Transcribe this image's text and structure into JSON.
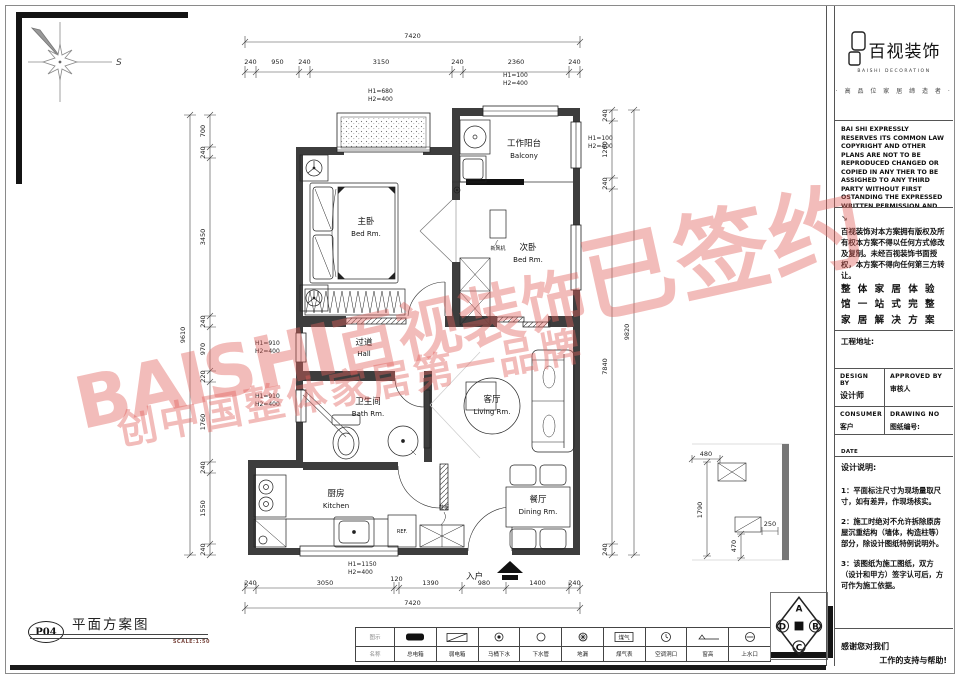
{
  "sheet": {
    "number": "P04",
    "title": "平面方案图",
    "scale": "SCALE:1:50"
  },
  "compass": {
    "south_label": "S"
  },
  "watermark": {
    "line1_latin": "BAISHI",
    "line1_cn": "百视装饰",
    "line1_tail": "已签约",
    "line2": "创中国整体家居第一品牌"
  },
  "plan": {
    "rooms": [
      {
        "cn": "主卧",
        "en": "Bed Rm."
      },
      {
        "cn": "工作阳台",
        "en": "Balcony"
      },
      {
        "cn": "次卧",
        "en": "Bed Rm."
      },
      {
        "cn": "过道",
        "en": "Hall"
      },
      {
        "cn": "卫生间",
        "en": "Bath Rm."
      },
      {
        "cn": "客厅",
        "en": "Living Rm."
      },
      {
        "cn": "厨房",
        "en": "Kitchen"
      },
      {
        "cn": "餐厅",
        "en": "Dining Rm."
      }
    ],
    "labels": {
      "entrance": "入户",
      "fridge": "REF.",
      "shoe_cabinet": "鞋柜",
      "fresh_air": "新风机"
    },
    "window_tags": [
      {
        "h1": "H1=680",
        "h2": "H2=400"
      },
      {
        "h1": "H1=100",
        "h2": "H2=400"
      },
      {
        "h1": "H1=100",
        "h2": "H2=400"
      },
      {
        "h1": "H1=910",
        "h2": "H2=400"
      },
      {
        "h1": "H1=910",
        "h2": "H2=400"
      },
      {
        "h1": "H1=1150",
        "h2": "H2=400"
      }
    ],
    "dims": {
      "top_total": "7420",
      "top": [
        "240",
        "950",
        "240",
        "3150",
        "240",
        "2360",
        "240"
      ],
      "left_total": "9610",
      "left": [
        "700",
        "240",
        "3450",
        "240",
        "970",
        "220",
        "1760",
        "240",
        "1550",
        "240"
      ],
      "right_total": "9820",
      "right": [
        "240",
        "1260",
        "240",
        "7840",
        "240"
      ],
      "bottom_total": "7420",
      "bottom": [
        "240",
        "3050",
        "120",
        "1390",
        "980",
        "1400",
        "240"
      ],
      "detail": [
        "480",
        "1790",
        "470",
        "250"
      ]
    }
  },
  "titleblock": {
    "logo_text": "百视装饰",
    "logo_sub": "BAISHI DECORATION",
    "tagline": "· 高 品 位 家 居 缔 造 者 ·",
    "copyright_en": "BAI SHI EXPRESSLY RESERVES ITS COMMON LAW COPYRIGHT AND OTHER PLANS ARE NOT TO BE REPRODUCED CHANGED OR COPIED IN ANY THER TO BE ASSIGHED TO ANY THIRD PARTY WITHOUT FIRST OSTANDING THE EXPRESSED WRITTEN PERMISSION AND CONSENT OF BAI SHI DECORATION",
    "copyright_cn": "百视装饰对本方案拥有版权及所有权本方案不得以任何方式修改及复制。未经百视装饰书面授权，本方案不得向任何第三方转让。",
    "slogan": "整 体 家 居 体 验 馆 一 站 式 完 整 家 居 解 决 方 案",
    "project_address_label": "工程地址:",
    "design_by": "DESIGN BY",
    "designer_label": "设计师",
    "approved_by": "APPROVED BY",
    "approver_label": "审核人",
    "consumer": "CONSUMER",
    "consumer_label": "客户",
    "drawing_no": "DRAWING NO",
    "drawing_no_label": "图纸编号:",
    "date": "DATE",
    "date_label": "出图日期:",
    "notes_title": "设计说明:",
    "note1": "1：平面标注尺寸为现场量取尺寸，如有差异，作现场核实。",
    "note2": "2：施工时绝对不允许拆除原房屋沉重结构（墙体，构造柱等）部分，除设计图纸特例说明外。",
    "note3": "3：该图纸为施工图纸，双方（设计和甲方）签字认可后，方可作为施工依据。"
  },
  "legend": {
    "header_top": "图示",
    "header_bottom": "名称",
    "gas_text": "煤气",
    "items": [
      {
        "label": "总电箱"
      },
      {
        "label": "弱电箱"
      },
      {
        "label": "马桶下水"
      },
      {
        "label": "下水管"
      },
      {
        "label": "地漏"
      },
      {
        "label": "煤气表"
      },
      {
        "label": "空调洞口"
      },
      {
        "label": "窗高"
      },
      {
        "label": "上水口"
      }
    ]
  },
  "footer": {
    "thanks1": "感谢您对我们",
    "thanks2": "工作的支持与帮助!",
    "diamond_letters": {
      "a": "A",
      "b": "B",
      "c": "C",
      "d": "D"
    }
  }
}
